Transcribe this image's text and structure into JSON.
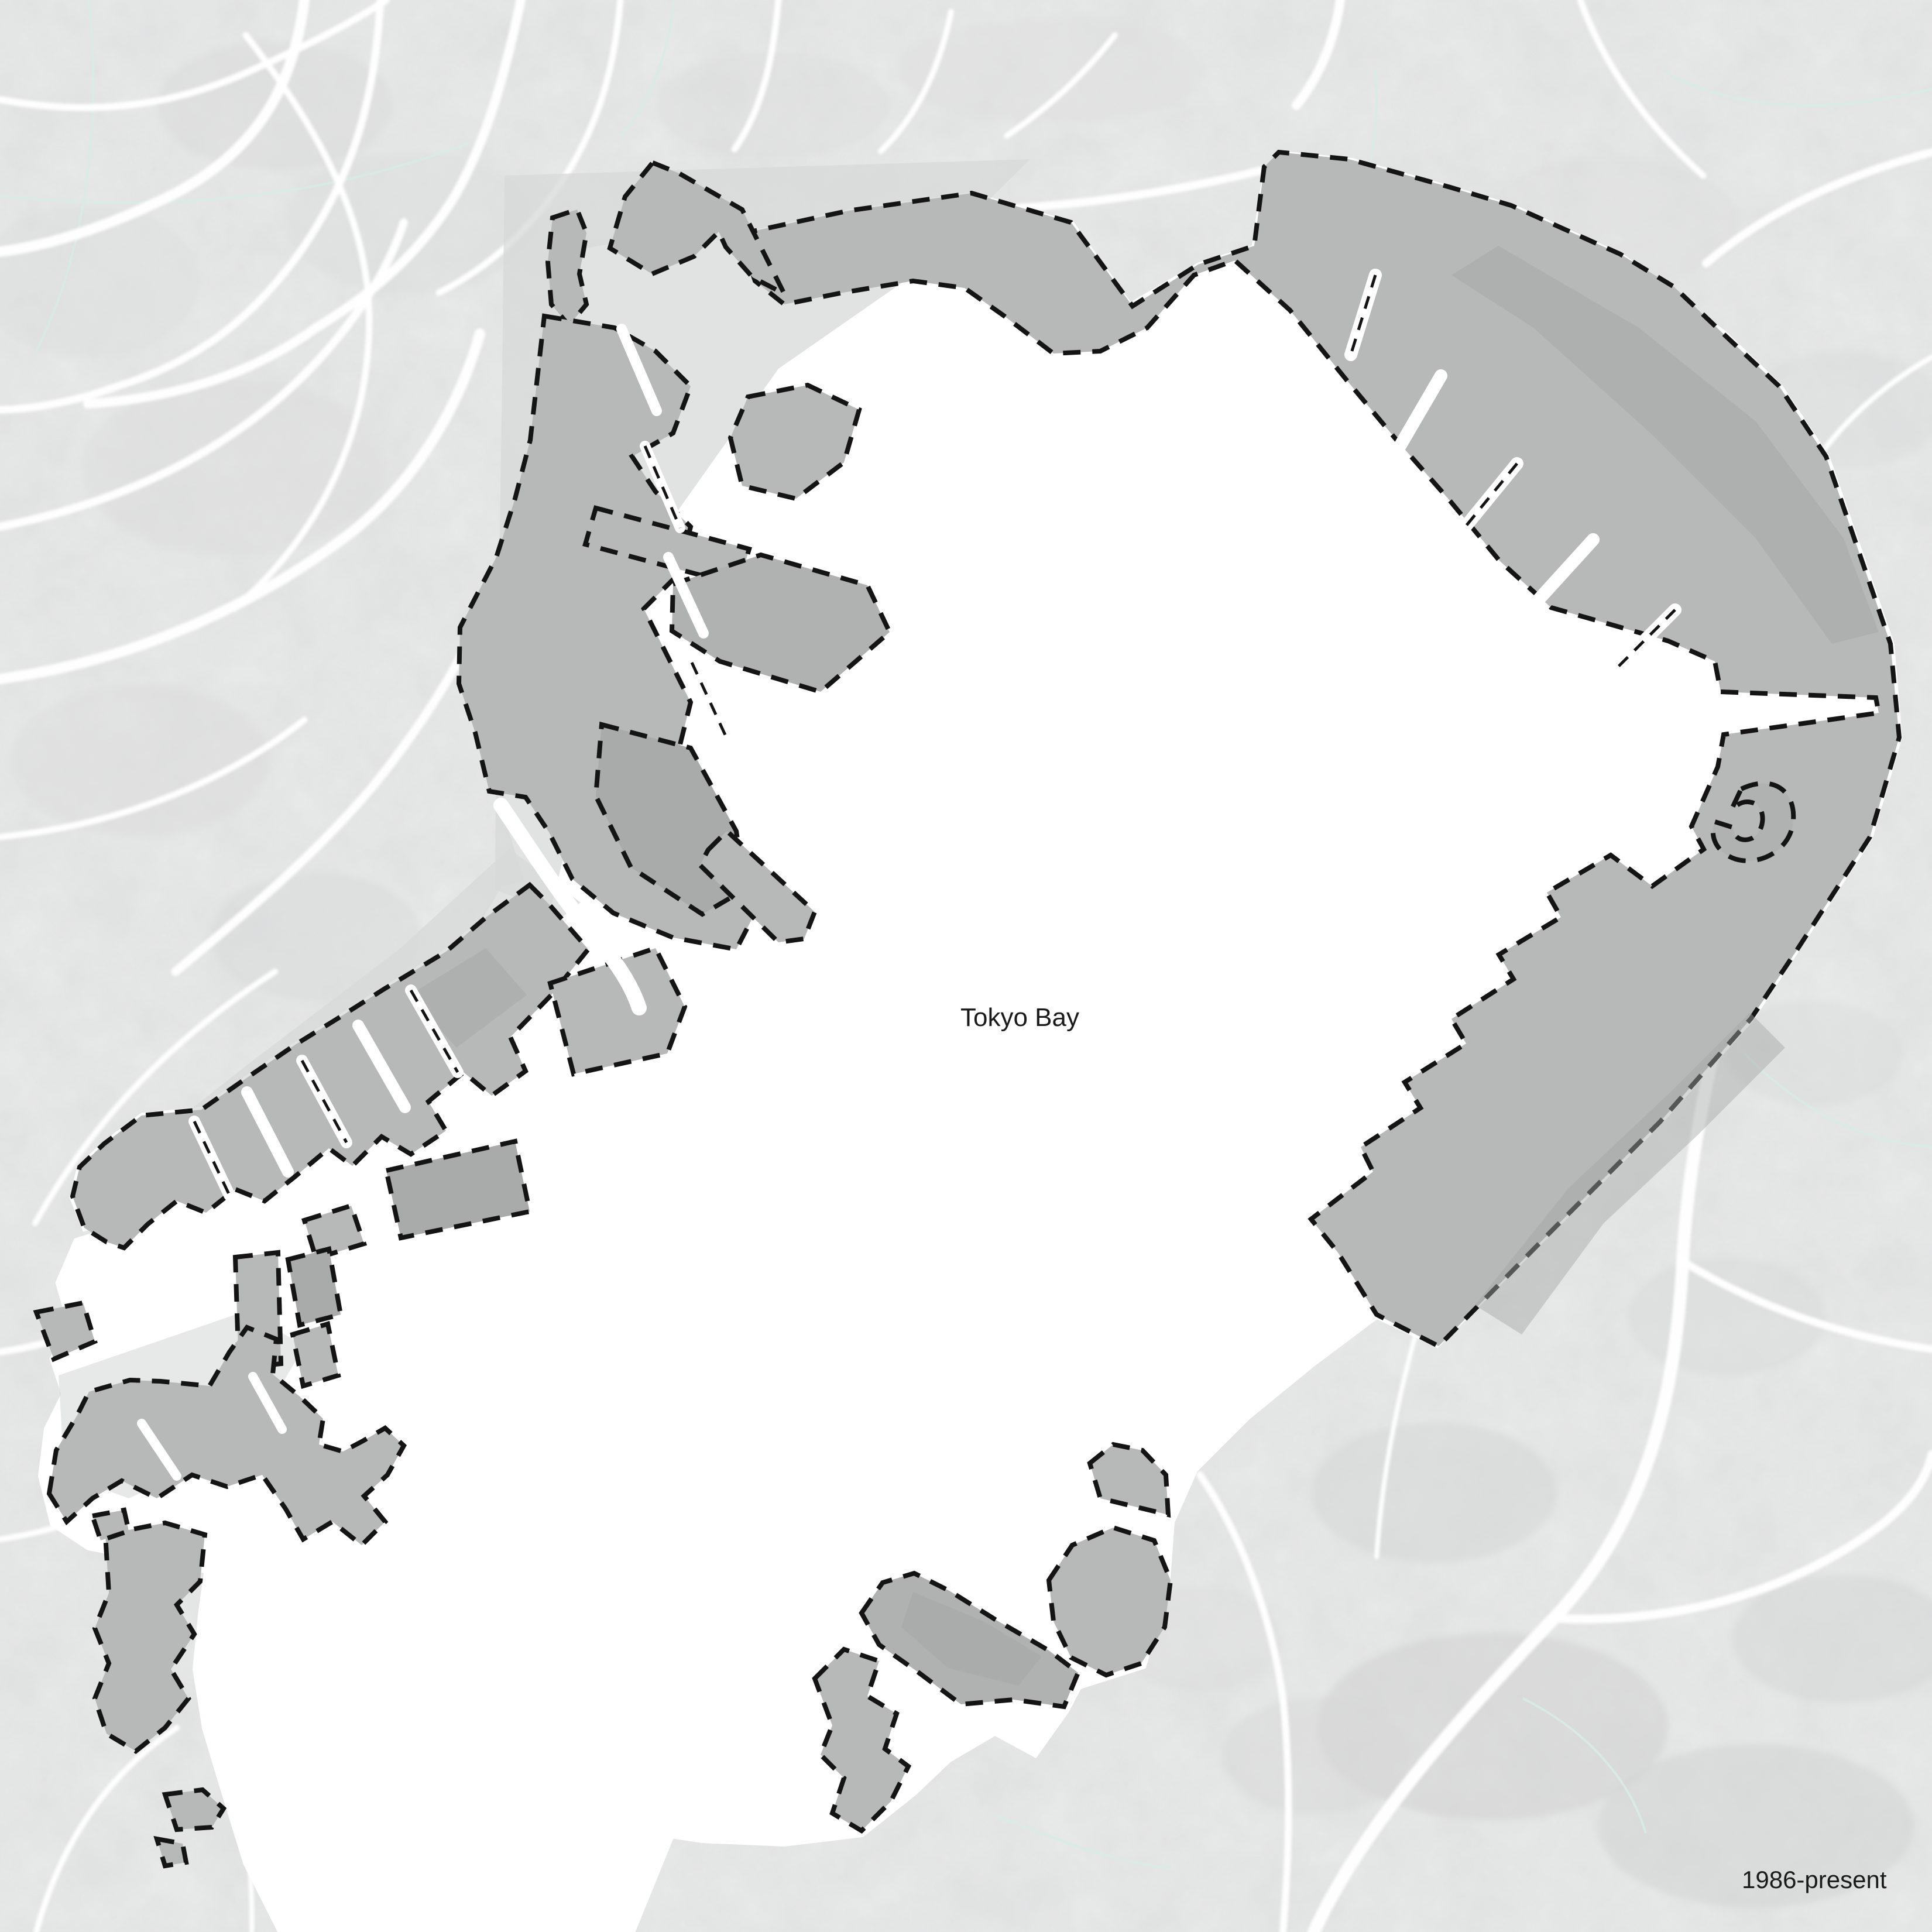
{
  "map": {
    "water_label": "Tokyo Bay",
    "period_label": "1986-present",
    "colors": {
      "land_base": "#ebecec",
      "land_mottle": "#d9dada",
      "water": "#ffffff",
      "roads": "#ffffff",
      "admin_boundary_line": "#d7ece3",
      "reclaimed_landfill_fill": "#b7b8b8",
      "reclaimed_landfill_dark": "#a9aaaa",
      "pre_1986_landfill_fill": "#d7d8d8",
      "boundary_dash": "#141414",
      "label_text": "#1a1a1a"
    }
  }
}
